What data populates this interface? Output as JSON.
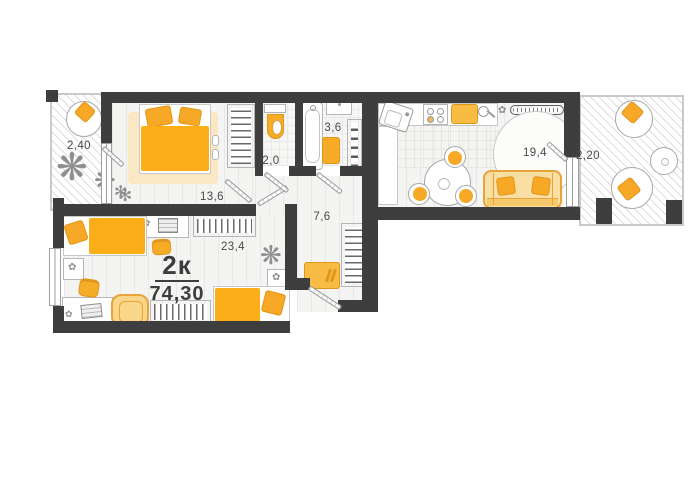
{
  "plan": {
    "title": {
      "rooms_label": "2к",
      "total_area": "74,30"
    },
    "rooms": [
      {
        "id": "balcony-left",
        "area": "2,40"
      },
      {
        "id": "bedroom",
        "area": "13,6"
      },
      {
        "id": "wc",
        "area": "2,0"
      },
      {
        "id": "bathroom",
        "area": "3,6"
      },
      {
        "id": "hallway",
        "area": "7,6"
      },
      {
        "id": "living-room",
        "area": "23,4"
      },
      {
        "id": "kitchen-living-room",
        "area": "19,4"
      },
      {
        "id": "balcony-right",
        "area": "2,20"
      }
    ],
    "colors": {
      "wall": "#3e3e3e",
      "accent_orange": "#F7AC28",
      "sofa_soft": "#F9DFA3",
      "rug_beige": "#FAE8C4",
      "floor": "#f4f4f2",
      "outline": "#b5b5b5",
      "label_text": "#4a4a4a"
    }
  },
  "icons": {
    "plant": "❋",
    "plant_small": "✻",
    "flower": "✿"
  }
}
